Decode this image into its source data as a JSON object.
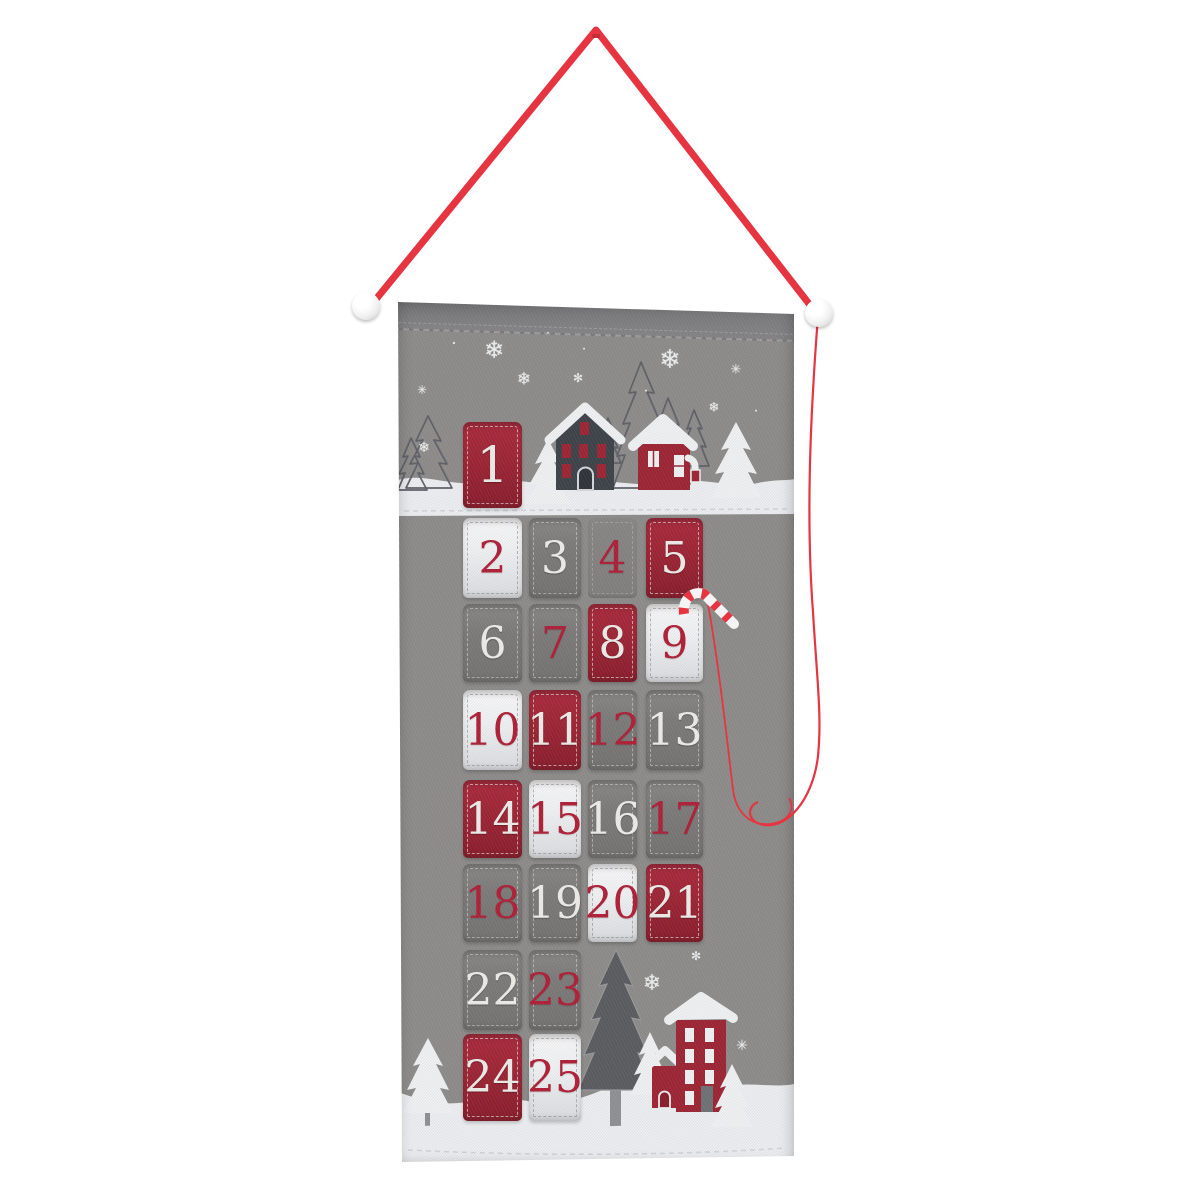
{
  "calendar": {
    "kind": "felt advent calendar wall hanging",
    "days_total": 25,
    "first_day": "1",
    "last_day": "25"
  },
  "colors": {
    "felt_gray": "#8e8d8b",
    "felt_gray_dark": "#7a797b",
    "pocket_gray": "#7d7c7b",
    "felt_red": "#9e2636",
    "felt_red_deep": "#8a1e2d",
    "felt_white": "#f1f2f4",
    "snow_white": "#edeff2",
    "ribbon_red": "#e63540",
    "number_red": "#b02139",
    "number_white": "#efedea",
    "house_dark": "#3f444b",
    "tree_dark": "#5b5d61",
    "embroidery_gray": "#60626a",
    "trunk_gray": "#8f9194",
    "door_gray": "#6f7376"
  },
  "hanger": {
    "pom_pom_count": 2,
    "pom_pom_color": "#ffffff",
    "has_candy_cane_charm": true
  },
  "pockets": [
    {
      "day": "1",
      "col": 1,
      "row": 1,
      "pocket": "red",
      "number": "white"
    },
    {
      "day": "2",
      "col": 1,
      "row": 2,
      "pocket": "white",
      "number": "red"
    },
    {
      "day": "3",
      "col": 2,
      "row": 2,
      "pocket": "gray",
      "number": "white"
    },
    {
      "day": "4",
      "col": 3,
      "row": 2,
      "pocket": "gray",
      "number": "red"
    },
    {
      "day": "5",
      "col": 4,
      "row": 2,
      "pocket": "red",
      "number": "white"
    },
    {
      "day": "6",
      "col": 1,
      "row": 3,
      "pocket": "gray",
      "number": "white"
    },
    {
      "day": "7",
      "col": 2,
      "row": 3,
      "pocket": "gray",
      "number": "red"
    },
    {
      "day": "8",
      "col": 3,
      "row": 3,
      "pocket": "red",
      "number": "white"
    },
    {
      "day": "9",
      "col": 4,
      "row": 3,
      "pocket": "white",
      "number": "red"
    },
    {
      "day": "10",
      "col": 1,
      "row": 4,
      "pocket": "white",
      "number": "red"
    },
    {
      "day": "11",
      "col": 2,
      "row": 4,
      "pocket": "red",
      "number": "white"
    },
    {
      "day": "12",
      "col": 3,
      "row": 4,
      "pocket": "gray",
      "number": "red"
    },
    {
      "day": "13",
      "col": 4,
      "row": 4,
      "pocket": "gray",
      "number": "white"
    },
    {
      "day": "14",
      "col": 1,
      "row": 5,
      "pocket": "red",
      "number": "white"
    },
    {
      "day": "15",
      "col": 2,
      "row": 5,
      "pocket": "white",
      "number": "red"
    },
    {
      "day": "16",
      "col": 3,
      "row": 5,
      "pocket": "gray",
      "number": "white"
    },
    {
      "day": "17",
      "col": 4,
      "row": 5,
      "pocket": "gray",
      "number": "red"
    },
    {
      "day": "18",
      "col": 1,
      "row": 6,
      "pocket": "gray",
      "number": "red"
    },
    {
      "day": "19",
      "col": 2,
      "row": 6,
      "pocket": "gray",
      "number": "white"
    },
    {
      "day": "20",
      "col": 3,
      "row": 6,
      "pocket": "white",
      "number": "red"
    },
    {
      "day": "21",
      "col": 4,
      "row": 6,
      "pocket": "red",
      "number": "white"
    },
    {
      "day": "22",
      "col": 1,
      "row": 7,
      "pocket": "gray",
      "number": "white"
    },
    {
      "day": "23",
      "col": 2,
      "row": 7,
      "pocket": "gray",
      "number": "red"
    },
    {
      "day": "24",
      "col": 1,
      "row": 8,
      "pocket": "red",
      "number": "white"
    },
    {
      "day": "25",
      "col": 2,
      "row": 8,
      "pocket": "white",
      "number": "red"
    }
  ],
  "snowflakes": [
    {
      "glyph": "❄",
      "x": 96,
      "y": 52,
      "size": 24
    },
    {
      "glyph": "✳",
      "x": 24,
      "y": 92,
      "size": 12
    },
    {
      "glyph": "❄",
      "x": 126,
      "y": 82,
      "size": 17
    },
    {
      "glyph": "✻",
      "x": 180,
      "y": 80,
      "size": 12
    },
    {
      "glyph": "❄",
      "x": 272,
      "y": 62,
      "size": 26
    },
    {
      "glyph": "✳",
      "x": 338,
      "y": 72,
      "size": 13
    },
    {
      "glyph": "❄",
      "x": 316,
      "y": 110,
      "size": 13
    },
    {
      "glyph": "❄",
      "x": 26,
      "y": 150,
      "size": 14
    },
    {
      "glyph": "•",
      "x": 56,
      "y": 46,
      "size": 7
    },
    {
      "glyph": "•",
      "x": 186,
      "y": 52,
      "size": 6
    },
    {
      "glyph": "•",
      "x": 248,
      "y": 94,
      "size": 6
    },
    {
      "glyph": "•",
      "x": 358,
      "y": 114,
      "size": 6
    },
    {
      "glyph": "•",
      "x": 150,
      "y": 36,
      "size": 5
    },
    {
      "glyph": "❄",
      "x": 254,
      "y": 686,
      "size": 22
    },
    {
      "glyph": "✻",
      "x": 298,
      "y": 658,
      "size": 12
    },
    {
      "glyph": "✳",
      "x": 344,
      "y": 748,
      "size": 14
    },
    {
      "glyph": "✻",
      "x": 206,
      "y": 620,
      "size": 11
    },
    {
      "glyph": "•",
      "x": 310,
      "y": 700,
      "size": 6
    },
    {
      "glyph": "•",
      "x": 232,
      "y": 640,
      "size": 5
    }
  ],
  "scene": {
    "top": [
      "embroidered pine trees",
      "white felt trees",
      "gray house with red windows",
      "red house with snow roof",
      "snow ground"
    ],
    "bottom": [
      "white felt trees",
      "dark pine tree",
      "red two-story house",
      "red annex house",
      "snow ground"
    ]
  }
}
